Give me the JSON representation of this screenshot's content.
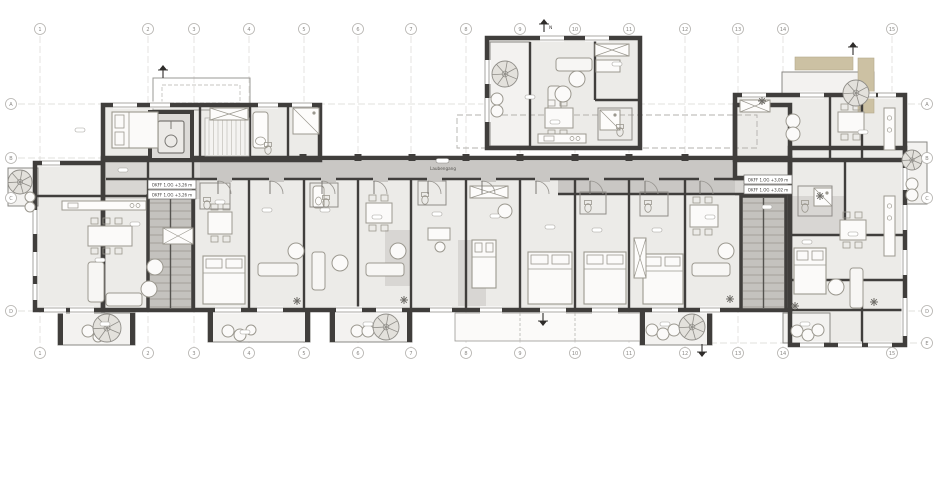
{
  "drawing": {
    "grid": {
      "columns": [
        "1",
        "2",
        "3",
        "4",
        "5",
        "6",
        "7",
        "8",
        "9",
        "10",
        "11",
        "12",
        "13",
        "14",
        "15"
      ],
      "rows_left": [
        "A",
        "B",
        "C",
        "D"
      ],
      "rows_right": [
        "A",
        "B",
        "C",
        "D",
        "E"
      ]
    },
    "labels": {
      "corridor": "Laubengang",
      "level_marks_left": [
        "OKFF 1.OG +3,26 m",
        "OKFF 1.OG +3,26 m"
      ],
      "level_marks_right": [
        "OKFF 1.OG +3,09 m",
        "OKFF 1.OG +3,02 m"
      ],
      "north_label": "N"
    },
    "colors": {
      "wall": "#403e3c",
      "room": "#ecebe8",
      "corridor": "#c9c7c4",
      "entry_gray": "#d8d6d3",
      "stair_core": "#c4c2be",
      "balcony": "#f3f2f0",
      "awning": "#ccc1a3",
      "grid_line": "#d9d7d3",
      "annotation_text": "#6f6d6a"
    }
  }
}
